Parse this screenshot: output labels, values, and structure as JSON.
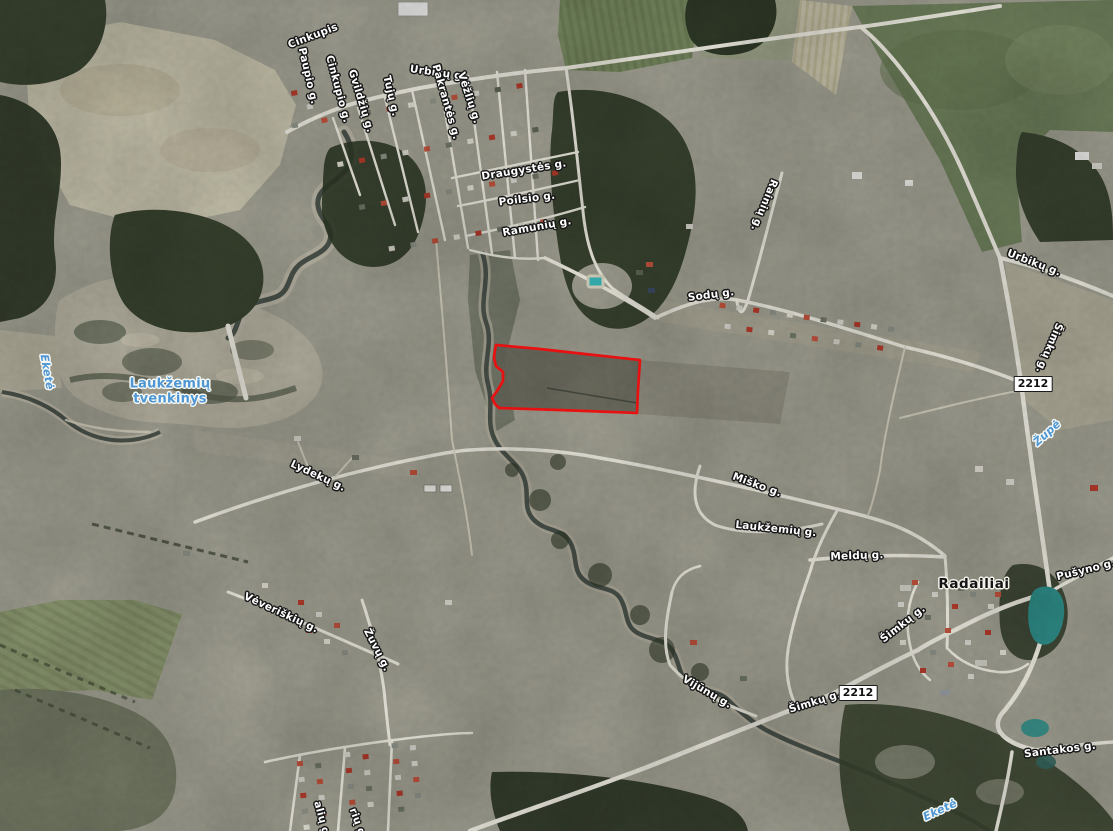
{
  "map": {
    "kind": "aerial-satellite-view",
    "parcel_outline_color": "#e81111"
  },
  "labels": [
    {
      "id": "cinkupis",
      "text": "Cinkupis"
    },
    {
      "id": "paupio",
      "text": "Paupio g."
    },
    {
      "id": "cinkupio",
      "text": "Cinkupio g."
    },
    {
      "id": "gvildziu",
      "text": "Gvildžių g."
    },
    {
      "id": "tuju",
      "text": "Tujų g."
    },
    {
      "id": "urbiku-nw",
      "text": "Urbikų g."
    },
    {
      "id": "pakrantes",
      "text": "Pakrantės g."
    },
    {
      "id": "vezliu",
      "text": "Vėžlių g."
    },
    {
      "id": "draugystes",
      "text": "Draugystės g."
    },
    {
      "id": "poilsio",
      "text": "Poilsio g."
    },
    {
      "id": "ramuniu",
      "text": "Ramunių g."
    },
    {
      "id": "rainiu",
      "text": "Rainių g."
    },
    {
      "id": "sodu",
      "text": "Sodų g."
    },
    {
      "id": "urbiku-ne",
      "text": "Urbikų g."
    },
    {
      "id": "simku-right",
      "text": "Šimkų g."
    },
    {
      "id": "zupe",
      "text": "Župė"
    },
    {
      "id": "lydeku",
      "text": "Lydekų g."
    },
    {
      "id": "misko",
      "text": "Miško g."
    },
    {
      "id": "laukzemiu-g",
      "text": "Laukžemių g."
    },
    {
      "id": "meldu",
      "text": "Meldų g."
    },
    {
      "id": "radailiai",
      "text": "Radailiai"
    },
    {
      "id": "pusyno",
      "text": "Pušyno g."
    },
    {
      "id": "simku-west",
      "text": "Šimkų g."
    },
    {
      "id": "veveriskiu",
      "text": "Vėveriškių g."
    },
    {
      "id": "zuvu",
      "text": "Žuvų g."
    },
    {
      "id": "vijunu",
      "text": "Vijūnų g."
    },
    {
      "id": "simku-south",
      "text": "Šimkų g."
    },
    {
      "id": "santakos",
      "text": "Santakos g."
    },
    {
      "id": "ekete-left",
      "text": "Eketė"
    },
    {
      "id": "ekete-bottom",
      "text": "Eketė"
    },
    {
      "id": "tvenkinys",
      "text": "Laukžemių tvenkinys"
    },
    {
      "id": "badge-north",
      "text": "2212"
    },
    {
      "id": "badge-south",
      "text": "2212"
    },
    {
      "id": "partial-sw-1",
      "text": "alių g."
    },
    {
      "id": "partial-sw-2",
      "text": "rių g."
    }
  ]
}
